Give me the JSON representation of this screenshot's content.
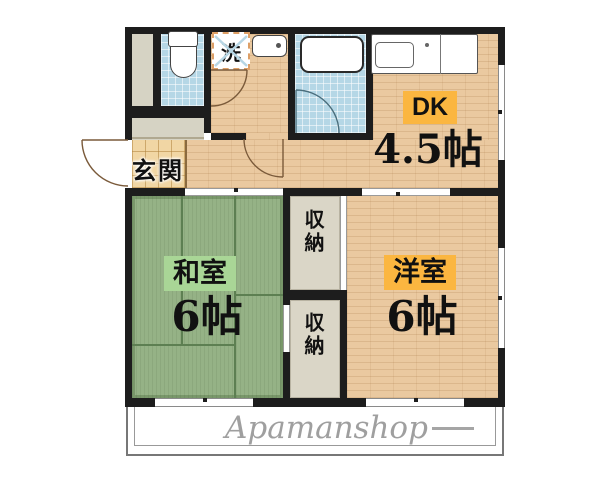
{
  "floorplan": {
    "watermark": {
      "text": "Apamanshop"
    },
    "rooms": {
      "dk": {
        "label": "DK",
        "size": "4.5帖"
      },
      "japanese_room": {
        "label": "和室",
        "size": "6帖"
      },
      "western_room": {
        "label": "洋室",
        "size": "6帖"
      },
      "entrance": {
        "label": "玄関"
      },
      "closet_upper": {
        "label": "収納"
      },
      "closet_lower": {
        "label": "収納"
      },
      "laundry": {
        "label": "洗"
      }
    },
    "colors": {
      "wall": "#1d1d1d",
      "wood_floor": "#eac9a0",
      "tatami_green": "#95b286",
      "tile_blue": "#b5d7e6",
      "entrance_tile": "#f1d6a4",
      "closet_floor": "#dad6c7",
      "label_orange": "#fbb640",
      "label_green": "#a9d696",
      "watermark_gray": "#8f8f8f"
    }
  }
}
